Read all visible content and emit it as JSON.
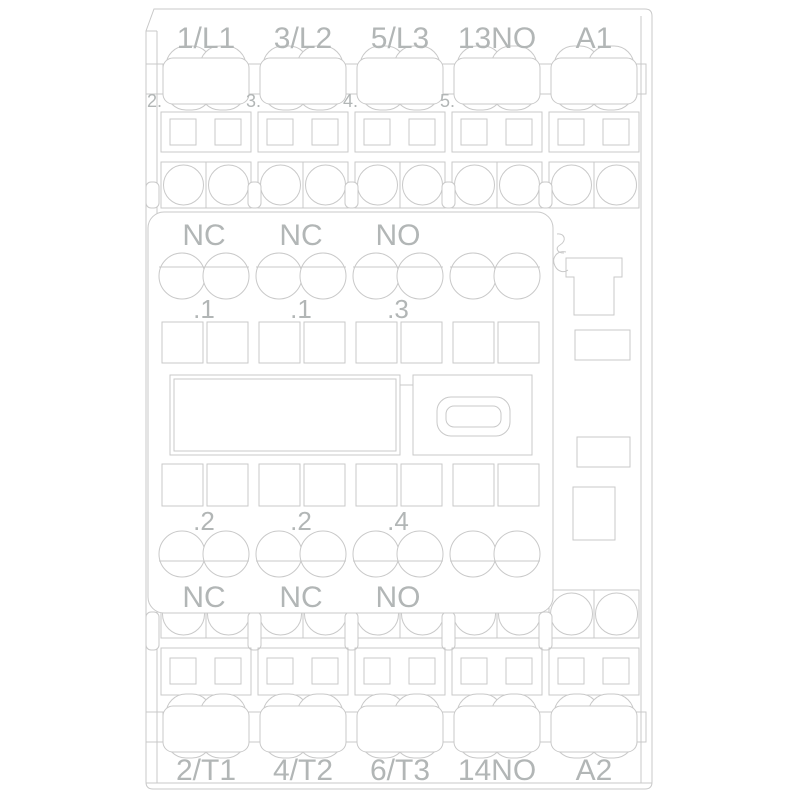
{
  "drawing_title": "contactor-front-view-line-drawing",
  "colors": {
    "background": "#ffffff",
    "line": "#c9c9c9",
    "text": "#b2b6b6"
  },
  "top_terminals": [
    "1/L1",
    "3/L2",
    "5/L3",
    "13NO",
    "A1"
  ],
  "bottom_terminals": [
    "2/T1",
    "4/T2",
    "6/T3",
    "14NO",
    "A2"
  ],
  "pole_markers": [
    "2.",
    "3.",
    "4.",
    "5."
  ],
  "aux_block": {
    "top_labels": [
      "NC",
      "NC",
      "NO"
    ],
    "top_numbers": [
      ".1",
      ".1",
      ".3"
    ],
    "bottom_numbers": [
      ".2",
      ".2",
      ".4"
    ],
    "bottom_labels": [
      "NC",
      "NC",
      "NO"
    ]
  }
}
